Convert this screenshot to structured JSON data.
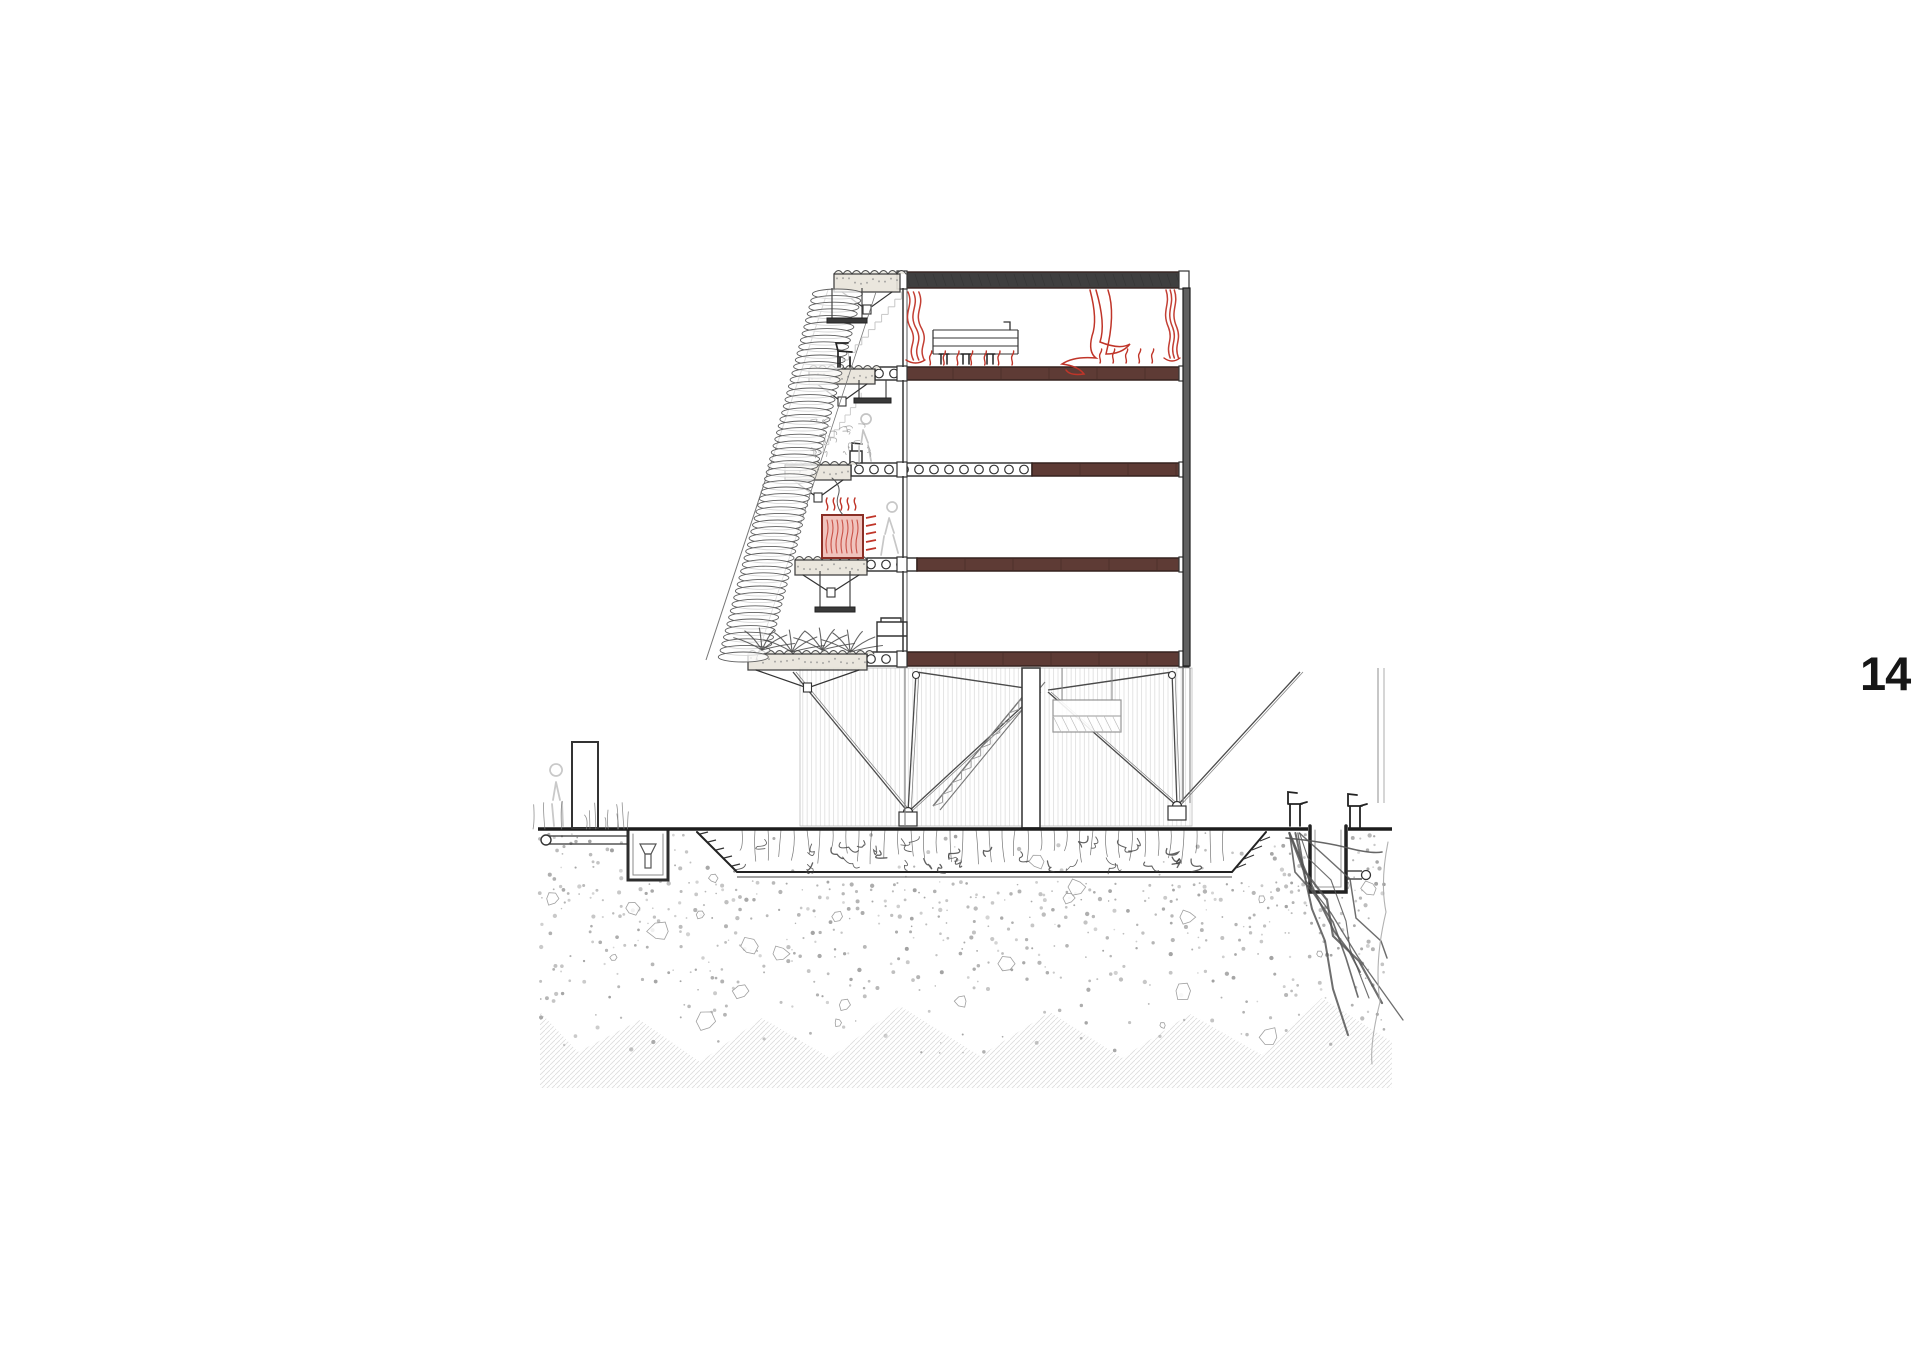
{
  "page": {
    "number": "14"
  },
  "drawing": {
    "colors": {
      "red": "#c03529",
      "blue": "#5577aa",
      "slab": "#5e3b35",
      "slab_edge": "#35221e",
      "roof_slab": "#3f3f3f",
      "ink": "#222222",
      "mid_gray": "#555555",
      "light_gray": "#9a9a9a",
      "ghost_gray": "#c8c8c8",
      "hatch_red_bg": "#f7ded9",
      "stove_bg": "#f0c3bd",
      "soil_dot": "#8a8a8a",
      "soil_hatch": "#d9d9d9"
    }
  }
}
